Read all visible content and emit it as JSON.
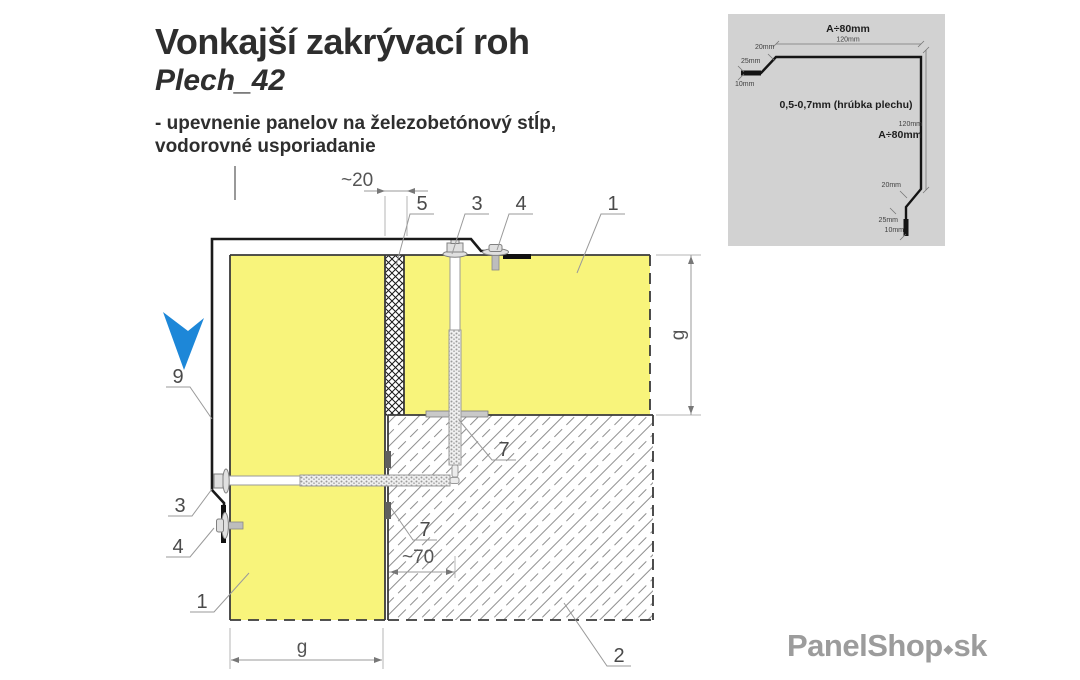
{
  "header": {
    "title": "Vonkajší zakrývací roh",
    "model": "Plech_42",
    "description_line1": "- upevnenie panelov na železobetónový stĺp,",
    "description_line2": "vodorovné usporiadanie"
  },
  "drawing": {
    "callouts": {
      "panel_top": "1",
      "panel_left": "1",
      "concrete": "2",
      "screw_top": "3",
      "screw_left": "3",
      "rivet_top": "4",
      "rivet_left": "4",
      "joint_seal": "5",
      "anchor_top": "7",
      "anchor_left": "7",
      "flashing": "9"
    },
    "dimensions": {
      "joint_width": "~20",
      "anchor_embedment": "~70",
      "panel_thickness_right": "g",
      "panel_thickness_bottom": "g"
    },
    "colors": {
      "panel_fill": "#f8f47b",
      "arrow_blue": "#1d87d8",
      "hatch_line": "#8f8f8f",
      "flashing_black": "#1a1a1a"
    }
  },
  "inset": {
    "top_flange_label": "A÷80mm",
    "top_flange_dim": "120mm",
    "left_bend": "20mm",
    "left_hem": "25mm",
    "left_fold": "10mm",
    "thickness_note": "0,5-0,7mm (hrúbka plechu)",
    "right_flange_dim": "120mm",
    "right_flange_label": "A÷80mm",
    "right_bend": "20mm",
    "right_hem": "25mm",
    "right_fold": "10mm"
  },
  "footer": {
    "brand": "PanelShop",
    "brand_icon": "◆",
    "brand_tld": "sk"
  }
}
